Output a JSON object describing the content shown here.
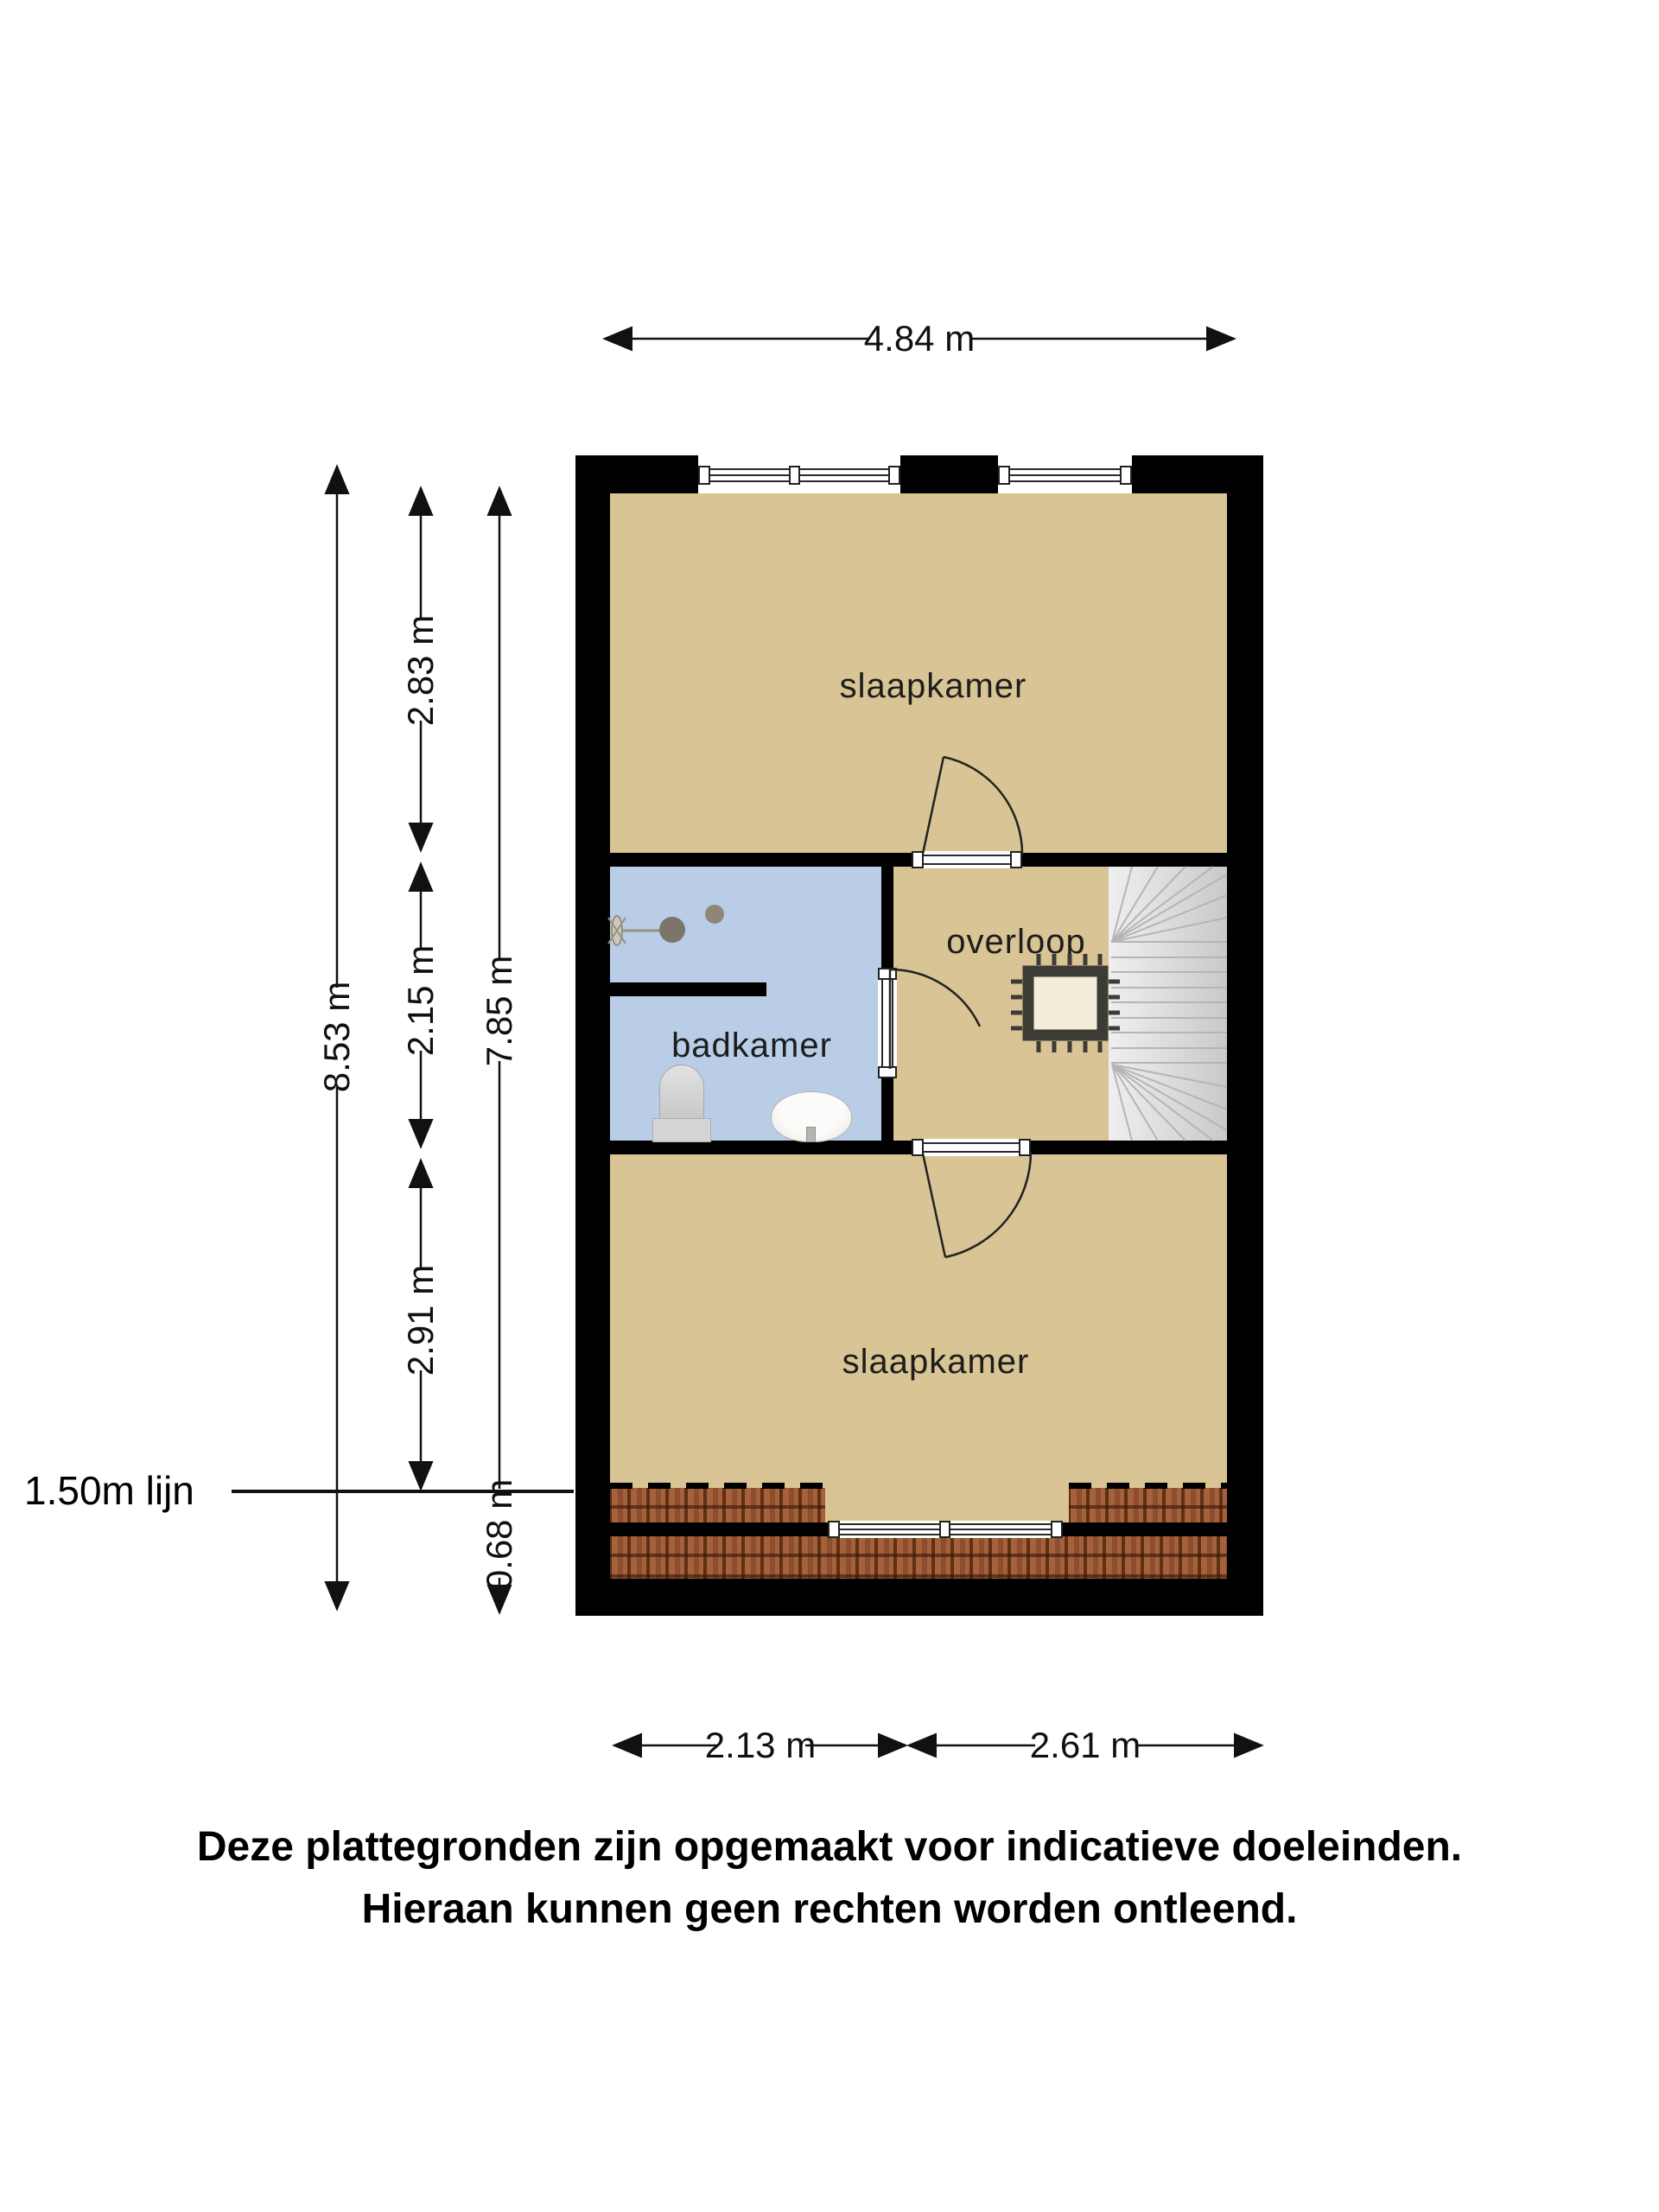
{
  "rooms": {
    "bedroom_top": "slaapkamer",
    "bathroom": "badkamer",
    "landing": "overloop",
    "bedroom_bottom": "slaapkamer"
  },
  "dimensions": {
    "top_width": "4.84 m",
    "left_total_height": "8.53 m",
    "left_segments": [
      "2.83 m",
      "2.15 m",
      "2.91 m"
    ],
    "inner_height": "7.85 m",
    "bottom_offset": "0.68 m",
    "bottom_widths": [
      "2.13 m",
      "2.61 m"
    ],
    "reference_line_label": "1.50m lijn"
  },
  "disclaimer": {
    "line1": "Deze plattegronden zijn opgemaakt voor indicatieve doeleinden.",
    "line2": "Hieraan kunnen geen rechten worden ontleend."
  },
  "colors": {
    "wall": "#000000",
    "floor": "#d8c494",
    "bathroom_floor": "#b9cde6",
    "roof_tiles": "#a2603f",
    "stairs": "#dcdcdc",
    "text": "#111111"
  }
}
